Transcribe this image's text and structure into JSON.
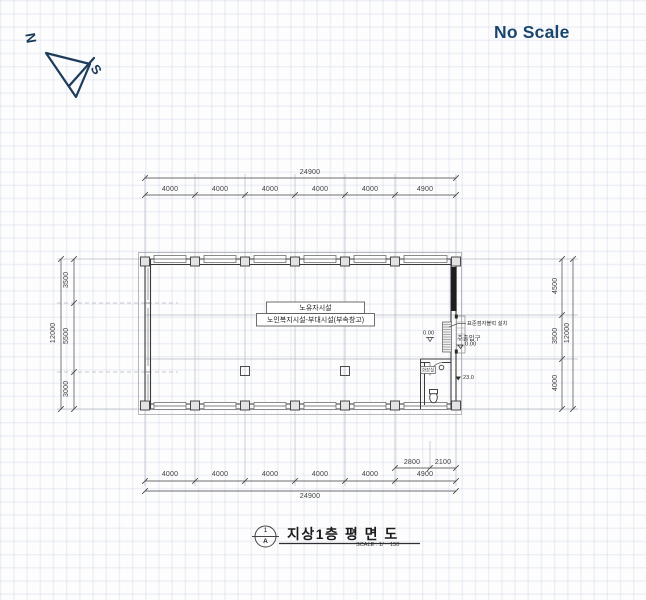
{
  "header": {
    "no_scale": "No Scale"
  },
  "compass": {
    "north": "N",
    "south": "S"
  },
  "colors": {
    "accent_blue": "#19466e",
    "ink": "#3a3a3a",
    "dim_text": "#3f3f3f",
    "grid_line": "#b5b9c2"
  },
  "plan": {
    "room_box": {
      "line1": "노유자시설",
      "line2": "노인복지시설-부대시설(부속창고)"
    },
    "annotations": {
      "braille": "표준점자블럭 설치",
      "entrance": "주출입구",
      "entrance_level": "0.00",
      "porch_level": "0.00",
      "toilet": "화장실",
      "side_level": "23.0"
    }
  },
  "dimensions": {
    "top": {
      "overall": "24900",
      "segments": [
        "4000",
        "4000",
        "4000",
        "4000",
        "4000",
        "4900"
      ]
    },
    "bottom": {
      "overall": "24900",
      "segments": [
        "4000",
        "4000",
        "4000",
        "4000",
        "4000",
        "4900"
      ],
      "sub_segments": [
        "2800",
        "2100"
      ]
    },
    "left": {
      "overall": "12000",
      "segments": [
        "3500",
        "5500",
        "3000"
      ]
    },
    "right": {
      "overall": "12000",
      "segments": [
        "4500",
        "3500",
        "4000"
      ]
    }
  },
  "title_block": {
    "ref_top": "1",
    "ref_bottom": "A",
    "title": "지상1층 평 면 도",
    "scale_label": "SCALE : 1/",
    "scale_value": "150"
  }
}
